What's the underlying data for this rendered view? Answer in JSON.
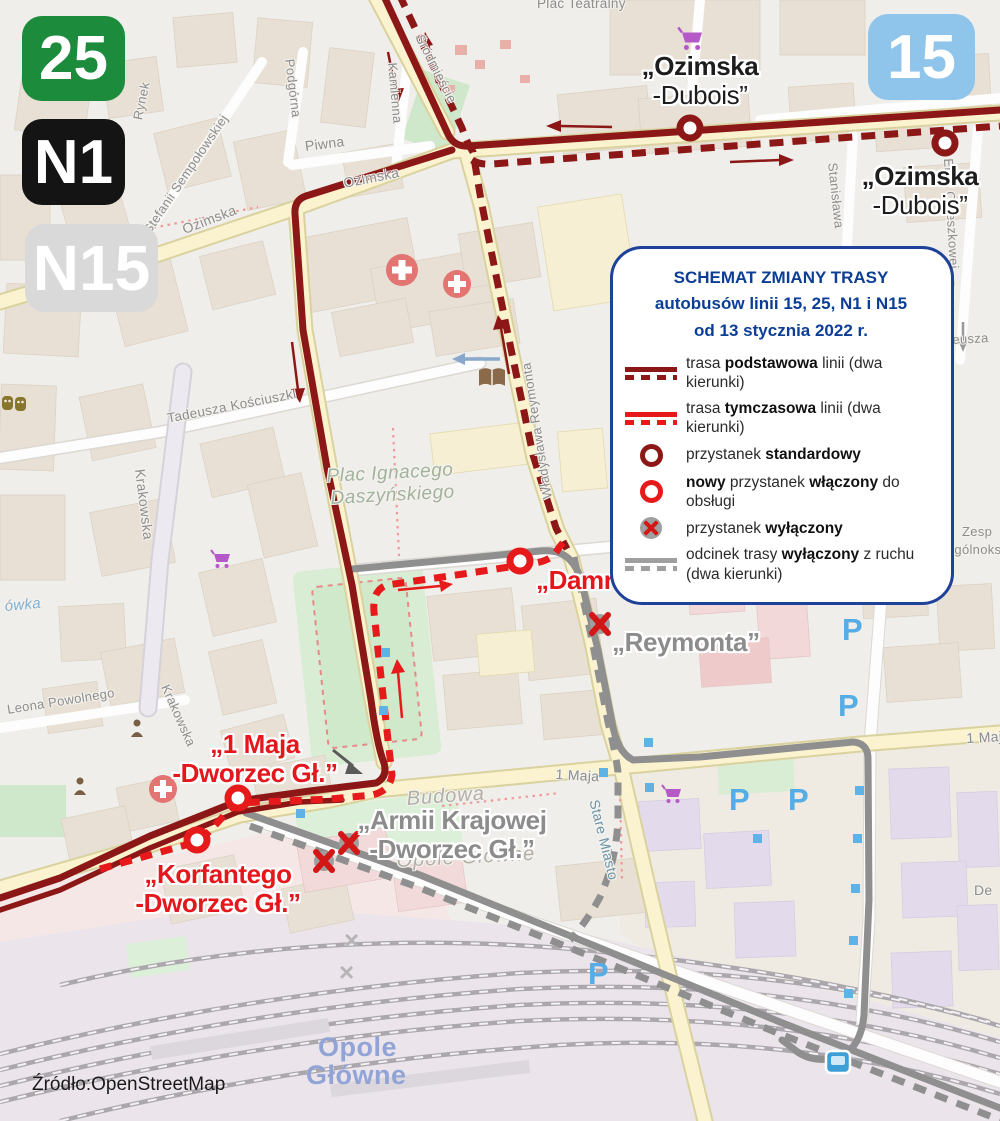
{
  "colors": {
    "route_basic": "#8c1717",
    "route_temporary": "#e61a1a",
    "route_excluded": "#9f9f9f",
    "legend_navy": "#0c3e96",
    "label_red": "#e3171c",
    "label_gray": "#8c8c8c",
    "badge_25": "#1c8b3c",
    "badge_n1": "#141414",
    "badge_n15": "#d9d9d9",
    "badge_15": "#8fc5ea"
  },
  "badges": [
    {
      "label": "25"
    },
    {
      "label": "N1"
    },
    {
      "label": "N15"
    },
    {
      "label": "15"
    }
  ],
  "legend": {
    "title_lines": [
      "SCHEMAT ZMIANY TRASY",
      "autobusów linii 15, 25, N1 i N15",
      "od 13 stycznia 2022 r."
    ],
    "items": [
      {
        "segments": [
          {
            "t": "trasa "
          },
          {
            "t": "podstawowa",
            "b": true
          },
          {
            "t": " linii (dwa kierunki)"
          }
        ]
      },
      {
        "segments": [
          {
            "t": "trasa "
          },
          {
            "t": "tymczasowa",
            "b": true
          },
          {
            "t": " linii (dwa kierunki)"
          }
        ]
      },
      {
        "segments": [
          {
            "t": "przystanek "
          },
          {
            "t": "standardowy",
            "b": true
          }
        ]
      },
      {
        "segments": [
          {
            "t": "nowy",
            "b": true
          },
          {
            "t": " przystanek "
          },
          {
            "t": "włączony",
            "b": true
          },
          {
            "t": " do obsługi"
          }
        ]
      },
      {
        "segments": [
          {
            "t": "przystanek "
          },
          {
            "t": "wyłączony",
            "b": true
          }
        ]
      },
      {
        "segments": [
          {
            "t": "odcinek trasy "
          },
          {
            "t": "wyłączony",
            "b": true
          },
          {
            "t": " z ruchu"
          },
          {
            "br": true
          },
          {
            "t": "(dwa kierunki)"
          }
        ]
      }
    ]
  },
  "stops": {
    "ozimska_dubois_top": [
      "„Ozimska",
      "-Dubois”"
    ],
    "ozimska_dubois_right": [
      "„Ozimska",
      "-Dubois”"
    ],
    "damrota": [
      "„Damrota”"
    ],
    "reymonta": [
      "„Reymonta”"
    ],
    "maja_dworzec": [
      "„1 Maja",
      "-Dworzec Gł.”"
    ],
    "korfantego_dworzec": [
      "„Korfantego",
      "-Dworzec Gł.”"
    ],
    "armii_dworzec": [
      "„Armii Krajowej",
      "-Dworzec Gł.”"
    ]
  },
  "map": {
    "labels": [
      {
        "t": "Plac Teatralny",
        "x": 537,
        "y": -4,
        "r": 0,
        "fs": 13.5
      },
      {
        "t": "Rynek",
        "x": 130,
        "y": 118,
        "r": -78
      },
      {
        "t": "Stefanii Sempołowskiej",
        "x": 140,
        "y": 228,
        "r": -56
      },
      {
        "t": "Podgórna",
        "x": 297,
        "y": 58,
        "r": 83
      },
      {
        "t": "Piwna",
        "x": 304,
        "y": 138,
        "r": -7,
        "fs": 14
      },
      {
        "t": "Kamienna",
        "x": 400,
        "y": 62,
        "r": 85
      },
      {
        "t": "Śródmieście",
        "x": 426,
        "y": 32,
        "r": 63
      },
      {
        "t": "Ozimska",
        "x": 180,
        "y": 222,
        "r": -21,
        "fs": 14
      },
      {
        "t": "Ozimska",
        "x": 342,
        "y": 175,
        "r": -11,
        "fs": 14
      },
      {
        "t": "Tadeusza Kościuszki",
        "x": 166,
        "y": 411,
        "r": -11,
        "fs": 13.5
      },
      {
        "t": "Krakowska",
        "x": 148,
        "y": 468,
        "r": 83,
        "fs": 14
      },
      {
        "t": "Krakowska",
        "x": 172,
        "y": 682,
        "r": 66,
        "fs": 13
      },
      {
        "t": "Leona Powolnego",
        "x": 6,
        "y": 702,
        "r": -9,
        "fs": 13
      },
      {
        "t": "Władysława Reymonta",
        "x": 540,
        "y": 500,
        "r": -99,
        "fs": 13
      },
      {
        "t": "1 Maja",
        "x": 556,
        "y": 766,
        "r": 3,
        "fs": 14
      },
      {
        "t": "1 Maja",
        "x": 966,
        "y": 730,
        "r": -3,
        "fs": 14
      },
      {
        "t": "Stare Miasto",
        "x": 602,
        "y": 798,
        "r": 76,
        "cls": "teal",
        "fs": 14
      },
      {
        "t": "Stanisława",
        "x": 840,
        "y": 162,
        "r": 84
      },
      {
        "t": "Elizy Orzeszkowej —",
        "x": 956,
        "y": 158,
        "r": 87
      },
      {
        "t": "eusza",
        "x": 952,
        "y": 332,
        "r": -3
      },
      {
        "t": "Zesp",
        "x": 962,
        "y": 524,
        "r": 0
      },
      {
        "t": "Ogólnoks",
        "x": 944,
        "y": 542,
        "r": 0
      },
      {
        "t": "De",
        "x": 974,
        "y": 882,
        "r": 0,
        "fs": 14
      },
      {
        "t": "ówka",
        "x": 4,
        "y": 598,
        "r": -5,
        "cls": "water",
        "fs": 15
      },
      {
        "t": "Budowa",
        "x": 406,
        "y": 788,
        "r": -4,
        "cls": "faint"
      },
      {
        "t": "Opole Główne",
        "x": 396,
        "y": 850,
        "r": -3,
        "cls": "faint"
      },
      {
        "t": "Plac Ignacego",
        "x": 326,
        "y": 466,
        "r": -3,
        "cls": "park"
      },
      {
        "t": "Daszyńskiego",
        "x": 330,
        "y": 488,
        "r": -3,
        "cls": "park"
      },
      {
        "t": "Opole",
        "x": 318,
        "y": 1032,
        "r": 0,
        "cls": "station"
      },
      {
        "t": "Główne",
        "x": 306,
        "y": 1060,
        "r": 0,
        "cls": "station"
      },
      {
        "t": "P",
        "x": 838,
        "y": 688,
        "r": 0,
        "cls": "pk",
        "name": "parking-icon"
      },
      {
        "t": "P",
        "x": 729,
        "y": 782,
        "r": 0,
        "cls": "pk",
        "name": "parking-icon"
      },
      {
        "t": "P",
        "x": 788,
        "y": 782,
        "r": 0,
        "cls": "pk",
        "name": "parking-icon"
      },
      {
        "t": "P",
        "x": 588,
        "y": 956,
        "r": 0,
        "cls": "pk",
        "name": "parking-icon"
      },
      {
        "t": "P",
        "x": 842,
        "y": 612,
        "r": 0,
        "cls": "pk",
        "name": "parking-icon"
      },
      {
        "t": "×",
        "x": 344,
        "y": 925,
        "r": 0,
        "cls": "crs",
        "name": "crossing-icon"
      },
      {
        "t": "×",
        "x": 339,
        "y": 957,
        "r": 0,
        "cls": "crs",
        "name": "crossing-icon"
      }
    ]
  },
  "source": "Źródło:OpenStreetMap"
}
